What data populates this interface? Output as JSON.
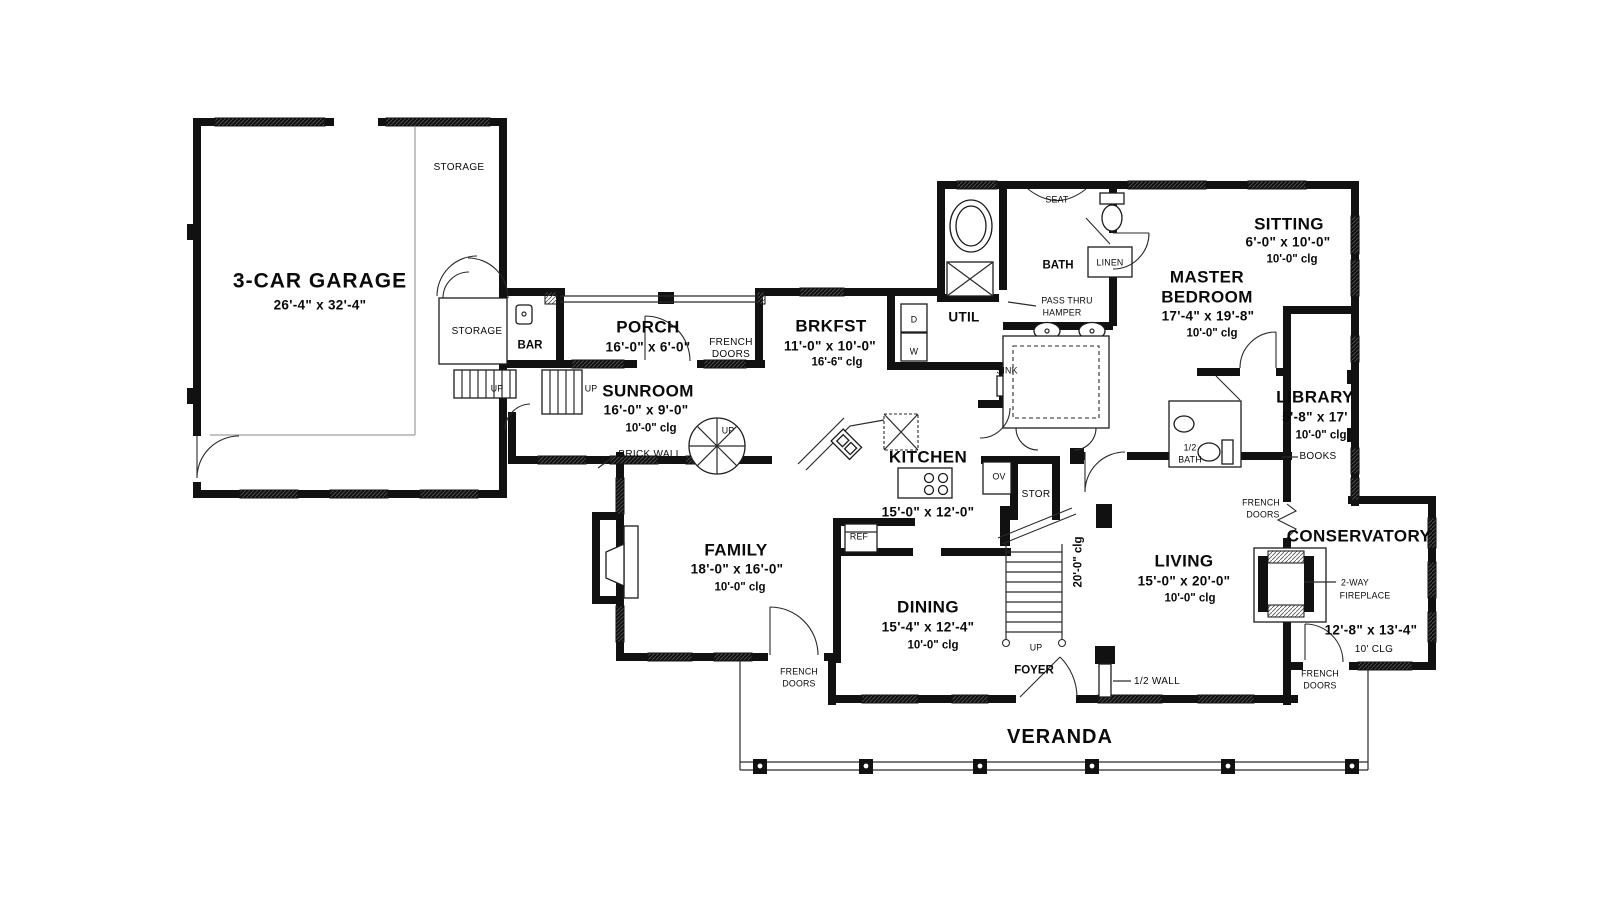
{
  "title": "First floor plan",
  "labels": {
    "garage_name": "3-CAR GARAGE",
    "garage_dims": "26'-4\" x 32'-4\"",
    "storage": "STORAGE",
    "bar": "BAR",
    "up": "UP",
    "porch_name": "PORCH",
    "porch_dims": "16'-0\" x 6'-0\"",
    "french": "FRENCH",
    "doors": "DOORS",
    "sunroom_name": "SUNROOM",
    "sunroom_dims": "16'-0\" x 9'-0\"",
    "clg_10_0": "10'-0\" clg",
    "brick_wall": "BRICK WALL",
    "brkfst_name": "BRKFST",
    "brkfst_dims": "11'-0\" x 10'-0\"",
    "brkfst_clg": "16'-6\" clg",
    "util": "UTIL",
    "seat": "SEAT",
    "bath": "BATH",
    "linen": "LINEN",
    "pass_thru": "PASS THRU",
    "hamper": "HAMPER",
    "sink": "SINK",
    "sitting_name": "SITTING",
    "sitting_dims": "6'-0\" x 10'-0\"",
    "master_name_1": "MASTER",
    "master_name_2": "BEDROOM",
    "master_dims": "17'-4\" x 19'-8\"",
    "library_name": "LIBRARY",
    "library_dims": "5'-8\" x 17'",
    "books": "BOOKS",
    "half": "1/2",
    "half_wall": "1/2 WALL",
    "kitchen_name": "KITCHEN",
    "kitchen_dims": "15'-0\" x 12'-0\"",
    "ov": "OV",
    "stor": "STOR",
    "ref": "REF",
    "clg_20": "20'-0\" clg",
    "family_name": "FAMILY",
    "family_dims": "18'-0\" x 16'-0\"",
    "dining_name": "DINING",
    "dining_dims": "15'-4\" x 12'-4\"",
    "living_name": "LIVING",
    "living_dims": "15'-0\" x 20'-0\"",
    "foyer": "FOYER",
    "conservatory_name": "CONSERVATORY",
    "conservatory_dims": "12'-8\" x 13'-4\"",
    "clg_10": "10' CLG",
    "fireplace_1": "2-WAY",
    "fireplace_2": "FIREPLACE",
    "veranda": "VERANDA",
    "appliance_d": "D",
    "appliance_w": "W"
  }
}
